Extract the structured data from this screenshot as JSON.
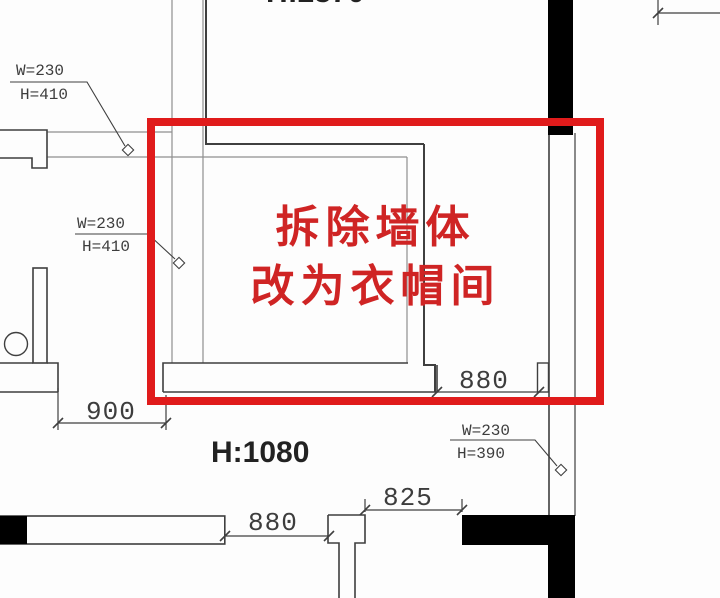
{
  "annotation": {
    "line1": "拆除墙体",
    "line2": "改为衣帽间"
  },
  "labels": {
    "top_left_w": "W=230",
    "top_left_h": "H=410",
    "mid_left_w": "W=230",
    "mid_left_h": "H=410",
    "bottom_right_w": "W=230",
    "bottom_right_h": "H=390"
  },
  "dimensions": {
    "left": "900",
    "mid_right": "880",
    "bottom": "880",
    "bottom_mid": "825"
  },
  "heights": {
    "upper_room": "H:2370",
    "lower_room": "H:1080"
  },
  "colors": {
    "highlight_box": "#e01b1b",
    "annotation_text": "#cf2424",
    "wall_fill": "#000000",
    "line_dark": "#3f3f3f",
    "line_light": "#8f8f8f"
  }
}
